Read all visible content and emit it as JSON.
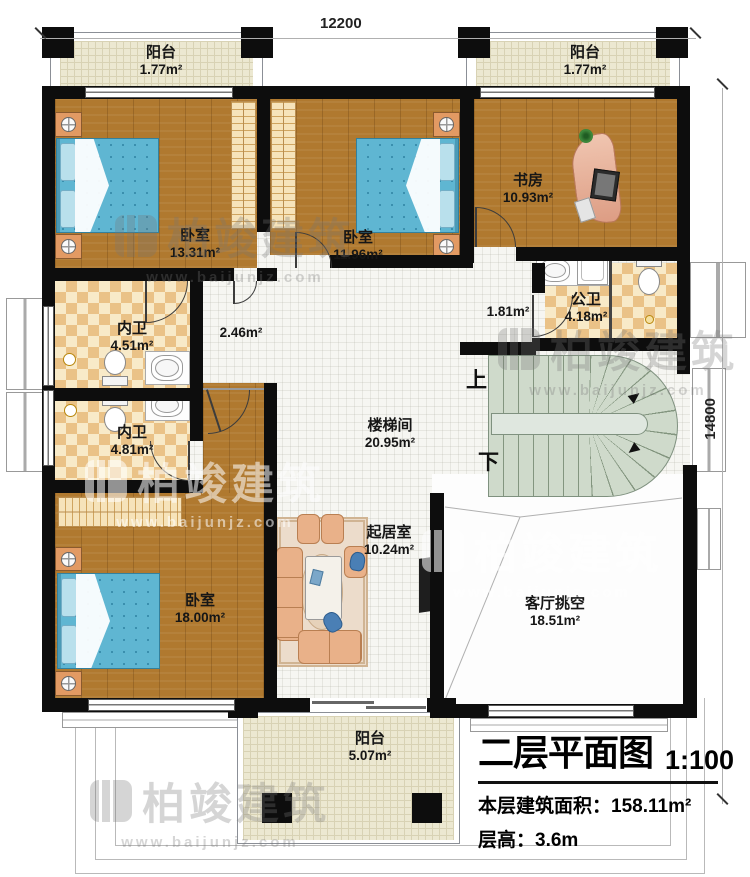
{
  "header": {
    "dim_top": "12200",
    "dim_right": "14800"
  },
  "rooms": {
    "balcony_tl": {
      "name": "阳台",
      "area": "1.77m²"
    },
    "balcony_tr": {
      "name": "阳台",
      "area": "1.77m²"
    },
    "bedroom1": {
      "name": "卧室",
      "area": "13.31m²"
    },
    "bedroom2": {
      "name": "卧室",
      "area": "11.96m²"
    },
    "study": {
      "name": "书房",
      "area": "10.93m²"
    },
    "public_bath": {
      "name": "公卫",
      "area": "4.18m²"
    },
    "bath1": {
      "name": "内卫",
      "area": "4.51m²"
    },
    "bath2": {
      "name": "内卫",
      "area": "4.81m²"
    },
    "bedroom3": {
      "name": "卧室",
      "area": "18.00m²"
    },
    "stairwell": {
      "name": "楼梯间",
      "area": "20.95m²"
    },
    "living": {
      "name": "起居室",
      "area": "10.24m²"
    },
    "void": {
      "name": "客厅挑空",
      "area": "18.51m²"
    },
    "balcony_b": {
      "name": "阳台",
      "area": "5.07m²"
    },
    "hall_a": {
      "area": "2.46m²"
    },
    "hall_b": {
      "area": "1.81m²"
    }
  },
  "stairs": {
    "up": "上",
    "down": "下"
  },
  "watermark": {
    "brand": "柏竣建筑",
    "url": "www.baijunjz.com"
  },
  "titleblock": {
    "title": "二层平面图",
    "scale": "1:100",
    "area_label": "本层建筑面积：",
    "area_value": "158.11m²",
    "height_label": "层高：",
    "height_value": "3.6m"
  },
  "colors": {
    "wall": "#0d0d0d",
    "wood": "#b0792f",
    "tile_cream": "#ece8d1",
    "tile_line": "#d8d2b4",
    "checker_a": "#eac287",
    "checker_b": "#f8eac8",
    "stair": "#cfdacb",
    "stair_line": "#83957f",
    "bed": "#5fb6d2",
    "bed_dot": "#3a8fae",
    "furn": "#e9b189",
    "furn_line": "#b97f52",
    "accent_gold": "#b8860b",
    "text": "#161616"
  }
}
